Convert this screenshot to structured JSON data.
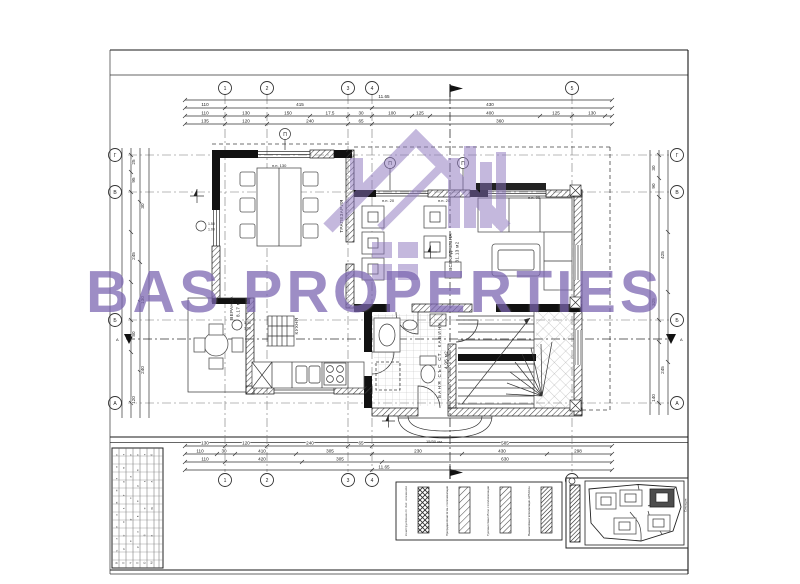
{
  "watermark": {
    "brand": "BAS PROPERTIES",
    "color": "#7c66b1"
  },
  "plan": {
    "overall_width": "11.65",
    "grid_columns": [
      "1",
      "2",
      "3",
      "4",
      "5"
    ],
    "grid_rows": [
      "Г",
      "В",
      "Б",
      "А"
    ],
    "section_marker": "А",
    "column_marker": "П",
    "rooms": {
      "dining": {
        "label": "ТРАПЕЗАРИЯ"
      },
      "living": {
        "label": "ВСЕКИДНЕВНА",
        "area": "31.13 м2"
      },
      "veranda": {
        "label": "ВЕРАНДА",
        "area": "8.17 м2"
      },
      "kitchen": {
        "label": "КУХНЯ"
      },
      "bath": {
        "label": "БАНЯ СЪС СТ. КАБИНА",
        "area": "4.95 м2"
      }
    },
    "notes": {
      "pp130": "п.п. 130",
      "pp20": "п.п. 20",
      "pp90": "п.п. 90"
    },
    "window_notes": {
      "w1": "1.50",
      "w1b": "1.00",
      "w2": "1.30",
      "w2b": "1.00"
    },
    "entry_note": "15/30 см.",
    "dims": {
      "top1": [
        "11.65"
      ],
      "top2": [
        "110",
        "415",
        "430"
      ],
      "top3": [
        "110",
        "130",
        "150",
        "17.5",
        "30",
        "100",
        "125",
        "400",
        "125",
        "130"
      ],
      "top4": [
        "135",
        "120",
        "240",
        "65",
        "360"
      ],
      "bottom1": [
        "130",
        "120",
        "240",
        "65",
        "585"
      ],
      "bottom2": [
        "110",
        "30",
        "410",
        "305",
        "230",
        "430",
        "298"
      ],
      "bottom3": [
        "110",
        "420",
        "305",
        "630"
      ],
      "bottom4": [
        "11.65"
      ],
      "left": [
        "25",
        "95",
        "30",
        "245",
        "130",
        "80",
        "240",
        "120"
      ],
      "right": [
        "30",
        "90",
        "425",
        "325",
        "245",
        "140"
      ]
    }
  },
  "legend": {
    "items": [
      {
        "label": "Конструктивни ст. бет. елементи"
      },
      {
        "label": "Преградни стени 12 см. с топлоизолация"
      },
      {
        "label": "Тухлени стени 25 см. с топлоизолация"
      },
      {
        "label": "Външни стени с топлоизолация - EPS 10 см."
      }
    ]
  },
  "title_block": {
    "rows": [
      "Възложител",
      "Проектант",
      "Чертал",
      "Проверил",
      "Обект",
      "Мащаб"
    ]
  },
  "site_plan": {
    "label": "Ситуация"
  }
}
